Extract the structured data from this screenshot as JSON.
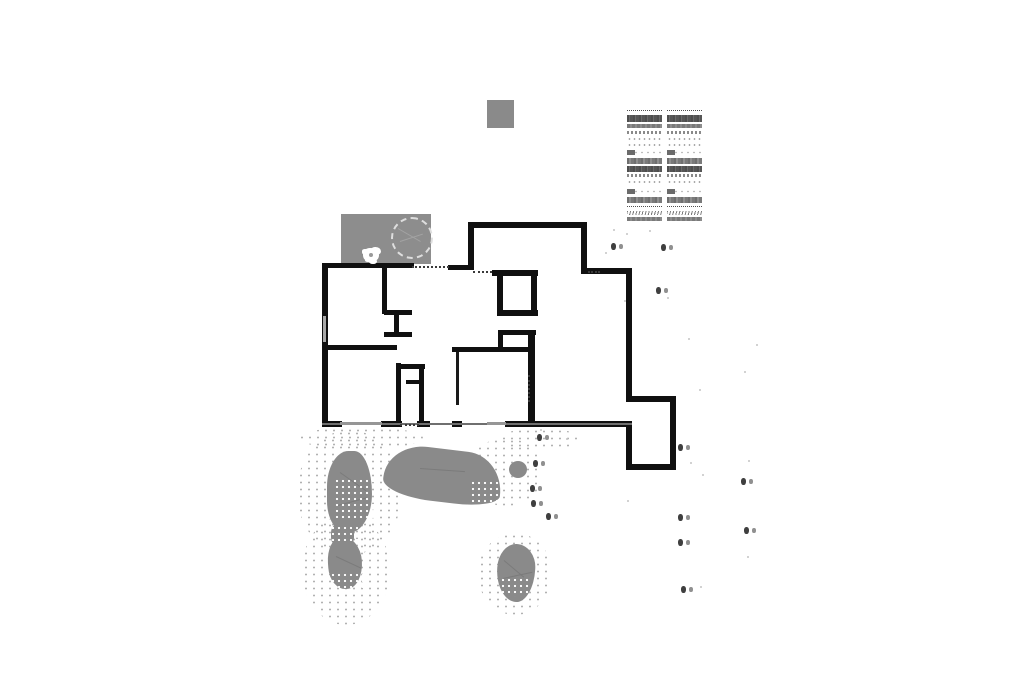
{
  "canvas": {
    "w": 1024,
    "h": 699,
    "bg": "#ffffff"
  },
  "colors": {
    "wall": "#101010",
    "fill_gray": "#8a8a8a",
    "patio_gray": "#8d8d8d",
    "stipple_dot": "#b2b2b2",
    "marker_dark": "#3f3f3f",
    "marker_light": "#909090",
    "speckle": "#c4c4c4"
  },
  "pad_square": {
    "x": 487,
    "y": 100,
    "w": 27,
    "h": 28
  },
  "patio": {
    "x": 341,
    "y": 214,
    "w": 90,
    "h": 50,
    "tree_circle": {
      "x": 391,
      "y": 217,
      "d": 38
    },
    "tree_lines": [
      [
        398,
        228,
        26,
        30
      ],
      [
        400,
        241,
        24,
        -18
      ]
    ],
    "flower": {
      "x": 363,
      "y": 248
    }
  },
  "schedule_table": {
    "x": 627,
    "y": 110,
    "col_w": 35,
    "gap": 5,
    "rows": [
      {
        "t": "dot",
        "h": 2,
        "mt": 0
      },
      {
        "t": "dark",
        "h": 7,
        "mt": 2
      },
      {
        "t": "med",
        "h": 4,
        "mt": 2
      },
      {
        "t": "text",
        "h": 3,
        "mt": 3
      },
      {
        "t": "sparse",
        "h": 4,
        "mt": 3
      },
      {
        "t": "sparse",
        "h": 4,
        "mt": 2
      },
      {
        "t": "blockleft",
        "h": 5,
        "mt": 3
      },
      {
        "t": "medtex",
        "h": 6,
        "mt": 3
      },
      {
        "t": "dark",
        "h": 6,
        "mt": 2
      },
      {
        "t": "text",
        "h": 3,
        "mt": 2
      },
      {
        "t": "sparse",
        "h": 5,
        "mt": 3
      },
      {
        "t": "blockleft",
        "h": 5,
        "mt": 4
      },
      {
        "t": "medtex",
        "h": 6,
        "mt": 3
      },
      {
        "t": "dot",
        "h": 2,
        "mt": 3
      },
      {
        "t": "zig",
        "h": 4,
        "mt": 2
      },
      {
        "t": "med",
        "h": 4,
        "mt": 2
      }
    ]
  },
  "plan": {
    "walls": [
      [
        322,
        263,
        6,
        162
      ],
      [
        322,
        263,
        92,
        5
      ],
      [
        448,
        265,
        26,
        5
      ],
      [
        468,
        222,
        6,
        47
      ],
      [
        468,
        222,
        119,
        6
      ],
      [
        581,
        222,
        6,
        52
      ],
      [
        581,
        268,
        51,
        6
      ],
      [
        626,
        268,
        6,
        133
      ],
      [
        626,
        396,
        50,
        6
      ],
      [
        670,
        396,
        6,
        74
      ],
      [
        626,
        464,
        50,
        6
      ],
      [
        626,
        421,
        6,
        49
      ],
      [
        322,
        421,
        20,
        6
      ],
      [
        381,
        421,
        21,
        6
      ],
      [
        417,
        421,
        13,
        6
      ],
      [
        452,
        421,
        10,
        6
      ],
      [
        505,
        421,
        127,
        6
      ],
      [
        382,
        265,
        5,
        49
      ],
      [
        384,
        310,
        28,
        5
      ],
      [
        394,
        315,
        5,
        19
      ],
      [
        384,
        332,
        28,
        5
      ],
      [
        327,
        345,
        70,
        5
      ],
      [
        452,
        347,
        79,
        5
      ],
      [
        396,
        363,
        5,
        60
      ],
      [
        396,
        364,
        29,
        5
      ],
      [
        419,
        364,
        5,
        59
      ],
      [
        406,
        380,
        18,
        4
      ],
      [
        492,
        270,
        46,
        6
      ],
      [
        497,
        276,
        6,
        36
      ],
      [
        531,
        270,
        6,
        46
      ],
      [
        497,
        310,
        41,
        6
      ],
      [
        498,
        330,
        38,
        5
      ],
      [
        498,
        335,
        5,
        16
      ],
      [
        528,
        330,
        7,
        95
      ]
    ],
    "thin_lines": [
      [
        322,
        423,
        310,
        2,
        "#6f6f6f"
      ],
      [
        340,
        422,
        42,
        3,
        "#969696"
      ],
      [
        487,
        422,
        19,
        3,
        "#969696"
      ],
      [
        323,
        316,
        3,
        26,
        "#a8a8a8"
      ],
      [
        456,
        352,
        3,
        53,
        "#1a1a1a"
      ]
    ],
    "dashed": [
      {
        "x": 412,
        "y": 266,
        "len": 37,
        "o": "h"
      },
      {
        "x": 473,
        "y": 271,
        "len": 19,
        "o": "h"
      },
      {
        "x": 588,
        "y": 271,
        "len": 12,
        "o": "h"
      },
      {
        "x": 400,
        "y": 424,
        "len": 19,
        "o": "h"
      },
      {
        "x": 528,
        "y": 375,
        "len": 27,
        "o": "v"
      }
    ]
  },
  "vegetation": {
    "halos": [
      {
        "x": 297,
        "y": 430,
        "w": 105,
        "h": 125,
        "sparse": true
      },
      {
        "x": 302,
        "y": 515,
        "w": 88,
        "h": 110,
        "sparse": true
      },
      {
        "x": 468,
        "y": 438,
        "w": 75,
        "h": 68,
        "sparse": true
      },
      {
        "x": 478,
        "y": 533,
        "w": 74,
        "h": 82,
        "sparse": true
      },
      {
        "x": 298,
        "y": 427,
        "w": 125,
        "h": 22,
        "sparse": true
      },
      {
        "x": 500,
        "y": 428,
        "w": 80,
        "h": 22,
        "sparse": true
      }
    ],
    "blobs": [
      {
        "x": 327,
        "y": 451,
        "w": 45,
        "h": 82,
        "br": "55% 45% 60% 50% / 50% 60% 55% 45%",
        "rot": 0
      },
      {
        "x": 331,
        "y": 523,
        "w": 23,
        "h": 24,
        "br": "40%",
        "rot": 0
      },
      {
        "x": 328,
        "y": 537,
        "w": 34,
        "h": 52,
        "br": "45% 55% 50% 50% / 50% 50% 55% 45%",
        "rot": -4
      },
      {
        "x": 384,
        "y": 449,
        "w": 118,
        "h": 53,
        "br": "50% 45% 55% 60% / 95% 110% 35% 45%",
        "rot": 7
      },
      {
        "x": 509,
        "y": 461,
        "w": 18,
        "h": 17,
        "br": "50%",
        "rot": 0
      },
      {
        "x": 497,
        "y": 544,
        "w": 38,
        "h": 58,
        "br": "48% 52% 46% 54% / 42% 40% 58% 56%",
        "rot": 3
      }
    ],
    "veins": [
      [
        340,
        472,
        32,
        35
      ],
      [
        338,
        505,
        30,
        -15
      ],
      [
        336,
        556,
        28,
        25
      ],
      [
        420,
        468,
        45,
        4
      ],
      [
        504,
        560,
        26,
        40
      ],
      [
        503,
        578,
        30,
        -12
      ]
    ],
    "speckle_patches": [
      {
        "x": 334,
        "y": 478,
        "w": 42,
        "h": 40
      },
      {
        "x": 330,
        "y": 525,
        "w": 28,
        "h": 16
      },
      {
        "x": 330,
        "y": 572,
        "w": 36,
        "h": 16
      },
      {
        "x": 470,
        "y": 480,
        "w": 32,
        "h": 25
      },
      {
        "x": 500,
        "y": 577,
        "w": 30,
        "h": 20
      }
    ]
  },
  "plant_markers": [
    [
      611,
      243
    ],
    [
      661,
      244
    ],
    [
      656,
      287
    ],
    [
      537,
      434
    ],
    [
      533,
      460
    ],
    [
      530,
      485
    ],
    [
      531,
      500
    ],
    [
      546,
      513
    ],
    [
      678,
      444
    ],
    [
      741,
      478
    ],
    [
      678,
      514
    ],
    [
      744,
      527
    ],
    [
      678,
      539
    ],
    [
      681,
      586
    ]
  ],
  "scatter_dots": [
    [
      613,
      229
    ],
    [
      626,
      233
    ],
    [
      649,
      230
    ],
    [
      605,
      252
    ],
    [
      667,
      297
    ],
    [
      624,
      300
    ],
    [
      688,
      338
    ],
    [
      756,
      344
    ],
    [
      744,
      371
    ],
    [
      699,
      389
    ],
    [
      748,
      460
    ],
    [
      690,
      462
    ],
    [
      627,
      500
    ],
    [
      702,
      474
    ],
    [
      747,
      556
    ],
    [
      700,
      586
    ],
    [
      540,
      429
    ],
    [
      566,
      438
    ]
  ]
}
